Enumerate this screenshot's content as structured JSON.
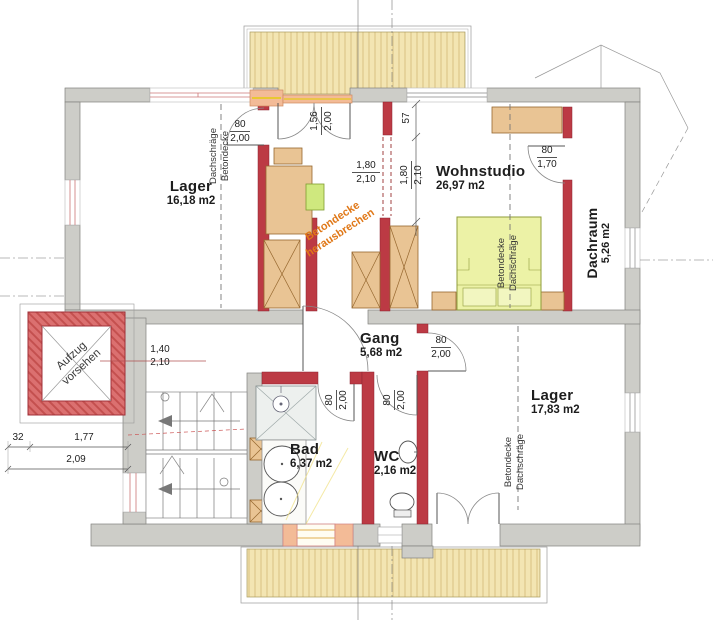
{
  "rooms": [
    {
      "name": "Lager",
      "area": "16,18 m2"
    },
    {
      "name": "Wohnstudio",
      "area": "26,97 m2"
    },
    {
      "name": "Dachraum",
      "area": "5,26 m2"
    },
    {
      "name": "Gang",
      "area": "5,68 m2"
    },
    {
      "name": "Lager",
      "area": "17,83 m2"
    },
    {
      "name": "Bad",
      "area": "6,37 m2"
    },
    {
      "name": "WC",
      "area": "2,16 m2"
    }
  ],
  "annotations": {
    "elevator": {
      "line1": "Aufzug",
      "line2": "vorsehen"
    },
    "ceiling_note": {
      "line1": "Betondecke",
      "line2": "herausbrechen"
    },
    "roof_left": {
      "line1": "Dachschräge",
      "line2": "Betondecke"
    },
    "roof_wohnstudio": {
      "line1": "Betondecke",
      "line2": "Dachschräge"
    },
    "roof_lager": {
      "line1": "Betondecke",
      "line2": "Dachschräge"
    }
  },
  "dimensions": {
    "lager_door": {
      "a": "80",
      "b": "2,00"
    },
    "balcony_door": {
      "a": "1,56",
      "b": "2,00"
    },
    "wall_seg": "57",
    "opening_front": {
      "a": "1,80",
      "b": "2,10"
    },
    "opening_side": {
      "a": "1,80",
      "b": "2,10"
    },
    "dachraum_door": {
      "a": "80",
      "b": "1,70"
    },
    "lager2_door": {
      "a": "80",
      "b": "2,00"
    },
    "bad_door": {
      "a": "80",
      "b": "2,00"
    },
    "wc_door": {
      "a": "80",
      "b": "2,00"
    },
    "hall_opening": {
      "a": "1,40",
      "b": "2,10"
    },
    "ext_a": "32",
    "ext_b": "1,77",
    "ext_c": "2,09"
  },
  "colors": {
    "wall_gray": "#cdcdc8",
    "masonry_red": "#bc3a44",
    "hatch_yellow": "#f3e5b2",
    "furniture_tan": "#e9c494",
    "bed_green": "#ecf2a6",
    "sill_salmon": "#f3bb97",
    "note_orange": "#e07818"
  }
}
